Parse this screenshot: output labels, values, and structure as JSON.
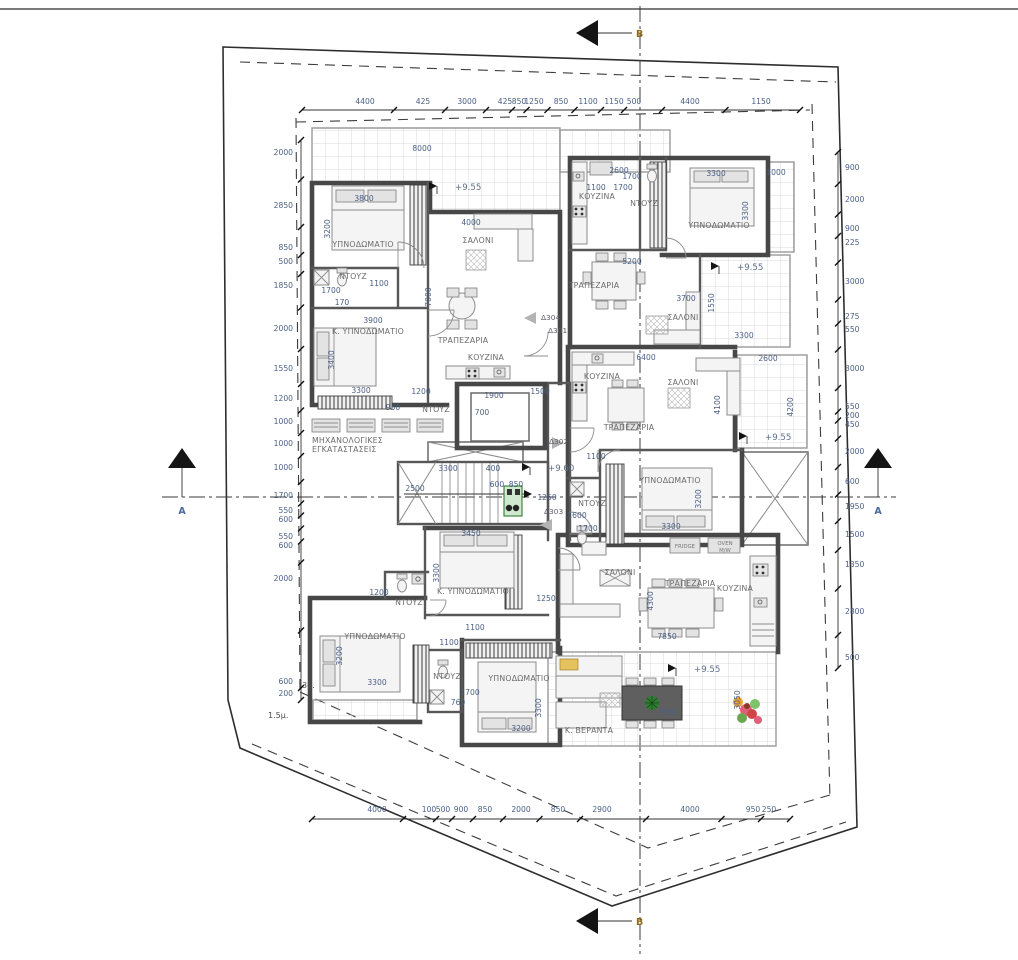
{
  "colors": {
    "dim_text": "#4a5f85",
    "room_text": "#6b6b6b",
    "level_text": "#5f6f8a",
    "section_a": "#4a68a0",
    "section_b": "#8a6a1a",
    "wall": "#474747",
    "plant_green": "#2e7d32",
    "cushion_yellow": "#e6c25e"
  },
  "section_markers": {
    "top": "B",
    "bottom": "B",
    "left": "A",
    "right": "A"
  },
  "levels": [
    {
      "t": "+9.55",
      "x": 455,
      "y": 190
    },
    {
      "t": "+9.55",
      "x": 737,
      "y": 270
    },
    {
      "t": "+9.55",
      "x": 765,
      "y": 440
    },
    {
      "t": "+9.60",
      "x": 548,
      "y": 471
    },
    {
      "t": "+9.55",
      "x": 694,
      "y": 672
    }
  ],
  "door_tags": [
    {
      "t": "Δ304",
      "x": 541,
      "y": 320
    },
    {
      "t": "Δ301",
      "x": 548,
      "y": 333
    },
    {
      "t": "Δ302",
      "x": 549,
      "y": 444
    },
    {
      "t": "Δ303",
      "x": 544,
      "y": 514
    }
  ],
  "setback_labels": [
    {
      "t": "3μ.",
      "x": 302,
      "y": 688
    },
    {
      "t": "1.5μ.",
      "x": 268,
      "y": 718
    }
  ],
  "rooms": [
    {
      "t": "ΥΠΝΟΔΩΜΑΤΙΟ",
      "x": 363,
      "y": 247
    },
    {
      "t": "ΣΑΛΟΝΙ",
      "x": 478,
      "y": 243
    },
    {
      "t": "ΝΤΟΥΖ",
      "x": 353,
      "y": 279
    },
    {
      "t": "Κ. ΥΠΝΟΔΩΜΑΤΙΟ",
      "x": 368,
      "y": 334
    },
    {
      "t": "ΤΡΑΠΕΖΑΡΙΑ",
      "x": 463,
      "y": 343
    },
    {
      "t": "ΚΟΥΖΙΝΑ",
      "x": 486,
      "y": 360
    },
    {
      "t": "ΜΗΧΑΝΟΛΟΓΙΚΕΣ",
      "x": 341,
      "y": 443,
      "a": "start",
      "ax": 312
    },
    {
      "t": "ΕΓΚΑΤΑΣΤΑΣΕΙΣ",
      "x": 338,
      "y": 452,
      "a": "start",
      "ax": 312
    },
    {
      "t": "ΚΟΥΖΙΝΑ",
      "x": 597,
      "y": 199
    },
    {
      "t": "ΝΤΟΥΖ",
      "x": 644,
      "y": 206
    },
    {
      "t": "ΥΠΝΟΔΩΜΑΤΙΟ",
      "x": 719,
      "y": 228
    },
    {
      "t": "ΤΡΑΠΕΖΑΡΙΑ",
      "x": 594,
      "y": 288
    },
    {
      "t": "ΣΑΛΟΝΙ",
      "x": 683,
      "y": 320
    },
    {
      "t": "ΚΟΥΖΙΝΑ",
      "x": 602,
      "y": 379
    },
    {
      "t": "ΣΑΛΟΝΙ",
      "x": 683,
      "y": 385
    },
    {
      "t": "ΤΡΑΠΕΖΑΡΙΑ",
      "x": 629,
      "y": 430
    },
    {
      "t": "ΝΤΟΥΖ",
      "x": 436,
      "y": 412
    },
    {
      "t": "ΥΠΝΟΔΩΜΑΤΙΟ",
      "x": 670,
      "y": 483
    },
    {
      "t": "ΝΤΟΥΖ",
      "x": 592,
      "y": 506
    },
    {
      "t": "Κ. ΥΠΝΟΔΩΜΑΤΙΟ",
      "x": 473,
      "y": 594
    },
    {
      "t": "ΝΤΟΥΖ",
      "x": 409,
      "y": 605
    },
    {
      "t": "ΥΠΝΟΔΩΜΑΤΙΟ",
      "x": 375,
      "y": 639
    },
    {
      "t": "ΝΤΟΥΖ",
      "x": 447,
      "y": 679
    },
    {
      "t": "ΥΠΝΟΔΩΜΑΤΙΟ",
      "x": 519,
      "y": 681
    },
    {
      "t": "ΣΑΛΟΝΙ",
      "x": 620,
      "y": 575
    },
    {
      "t": "ΤΡΑΠΕΖΑΡΙΑ",
      "x": 690,
      "y": 586
    },
    {
      "t": "ΚΟΥΖΙΝΑ",
      "x": 735,
      "y": 591
    },
    {
      "t": "Κ. ΒΕΡΑΝΤΑ",
      "x": 589,
      "y": 733
    }
  ],
  "appliance_labels": [
    {
      "t": "FRIDGE",
      "x": 685,
      "y": 548
    },
    {
      "t": "OVEN",
      "x": 725,
      "y": 545
    },
    {
      "t": "M/W",
      "x": 725,
      "y": 552
    }
  ],
  "plan_dims": [
    {
      "t": "8000",
      "x": 422,
      "y": 151
    },
    {
      "t": "2600",
      "x": 619,
      "y": 173
    },
    {
      "t": "3800",
      "x": 364,
      "y": 201
    },
    {
      "t": "3200",
      "x": 330,
      "y": 229,
      "r": -90
    },
    {
      "t": "4000",
      "x": 471,
      "y": 225
    },
    {
      "t": "1100",
      "x": 379,
      "y": 286
    },
    {
      "t": "1700",
      "x": 331,
      "y": 293
    },
    {
      "t": "170",
      "x": 342,
      "y": 305
    },
    {
      "t": "7000",
      "x": 431,
      "y": 297,
      "r": -90
    },
    {
      "t": "3900",
      "x": 373,
      "y": 323
    },
    {
      "t": "3400",
      "x": 334,
      "y": 360,
      "r": -90
    },
    {
      "t": "3300",
      "x": 361,
      "y": 393
    },
    {
      "t": "950",
      "x": 393,
      "y": 410
    },
    {
      "t": "1200",
      "x": 421,
      "y": 394
    },
    {
      "t": "1900",
      "x": 494,
      "y": 398
    },
    {
      "t": "1500",
      "x": 540,
      "y": 394
    },
    {
      "t": "700",
      "x": 482,
      "y": 415
    },
    {
      "t": "3300",
      "x": 448,
      "y": 471
    },
    {
      "t": "400",
      "x": 493,
      "y": 471
    },
    {
      "t": "600",
      "x": 497,
      "y": 487
    },
    {
      "t": "850",
      "x": 516,
      "y": 487
    },
    {
      "t": "2500",
      "x": 415,
      "y": 491
    },
    {
      "t": "1250",
      "x": 547,
      "y": 500
    },
    {
      "t": "1600",
      "x": 577,
      "y": 518
    },
    {
      "t": "1700",
      "x": 588,
      "y": 531
    },
    {
      "t": "3450",
      "x": 471,
      "y": 536
    },
    {
      "t": "1100",
      "x": 596,
      "y": 190
    },
    {
      "t": "1700",
      "x": 632,
      "y": 179
    },
    {
      "t": "1700",
      "x": 623,
      "y": 190
    },
    {
      "t": "3300",
      "x": 716,
      "y": 176
    },
    {
      "t": "3300",
      "x": 748,
      "y": 211,
      "r": -90
    },
    {
      "t": "1000",
      "x": 776,
      "y": 175
    },
    {
      "t": "5200",
      "x": 632,
      "y": 264
    },
    {
      "t": "3700",
      "x": 686,
      "y": 301
    },
    {
      "t": "1550",
      "x": 714,
      "y": 303,
      "r": -90
    },
    {
      "t": "3300",
      "x": 744,
      "y": 338
    },
    {
      "t": "6400",
      "x": 646,
      "y": 360
    },
    {
      "t": "2600",
      "x": 768,
      "y": 361
    },
    {
      "t": "4100",
      "x": 720,
      "y": 405,
      "r": -90
    },
    {
      "t": "4200",
      "x": 793,
      "y": 407,
      "r": -90
    },
    {
      "t": "1100",
      "x": 596,
      "y": 459
    },
    {
      "t": "3200",
      "x": 701,
      "y": 499,
      "r": -90
    },
    {
      "t": "3300",
      "x": 671,
      "y": 529
    },
    {
      "t": "3300",
      "x": 439,
      "y": 573,
      "r": -90
    },
    {
      "t": "1250",
      "x": 546,
      "y": 601
    },
    {
      "t": "1200",
      "x": 379,
      "y": 595
    },
    {
      "t": "1100",
      "x": 475,
      "y": 630
    },
    {
      "t": "1100",
      "x": 449,
      "y": 645
    },
    {
      "t": "3200",
      "x": 342,
      "y": 656,
      "r": -90
    },
    {
      "t": "3300",
      "x": 377,
      "y": 685
    },
    {
      "t": "1700",
      "x": 470,
      "y": 695
    },
    {
      "t": "760",
      "x": 458,
      "y": 705
    },
    {
      "t": "3300",
      "x": 541,
      "y": 708,
      "r": -90
    },
    {
      "t": "3200",
      "x": 521,
      "y": 731
    },
    {
      "t": "4300",
      "x": 653,
      "y": 601,
      "r": -90
    },
    {
      "t": "7850",
      "x": 667,
      "y": 639
    },
    {
      "t": "3050",
      "x": 740,
      "y": 700,
      "r": -90
    },
    {
      "t": "7850",
      "x": 667,
      "y": 715
    }
  ],
  "dimensions": {
    "top": {
      "axis": "x",
      "label_y": 104,
      "line": {
        "x1": 302,
        "y1": 110,
        "x2": 800,
        "y2": 110
      },
      "labels": [
        {
          "t": "4400",
          "x": 365
        },
        {
          "t": "425",
          "x": 423
        },
        {
          "t": "3000",
          "x": 467
        },
        {
          "t": "425",
          "x": 505
        },
        {
          "t": "850",
          "x": 519
        },
        {
          "t": "1250",
          "x": 534
        },
        {
          "t": "850",
          "x": 561
        },
        {
          "t": "1100",
          "x": 588
        },
        {
          "t": "1150",
          "x": 614
        },
        {
          "t": "500",
          "x": 634
        },
        {
          "t": "4400",
          "x": 690
        },
        {
          "t": "1150",
          "x": 761
        }
      ]
    },
    "bottom": {
      "axis": "x",
      "label_y": 812,
      "line": {
        "x1": 312,
        "y1": 819,
        "x2": 790,
        "y2": 819
      },
      "labels": [
        {
          "t": "4000",
          "x": 377
        },
        {
          "t": "100",
          "x": 429
        },
        {
          "t": "500",
          "x": 443
        },
        {
          "t": "900",
          "x": 461
        },
        {
          "t": "850",
          "x": 485
        },
        {
          "t": "2000",
          "x": 521
        },
        {
          "t": "850",
          "x": 558
        },
        {
          "t": "2900",
          "x": 602
        },
        {
          "t": "4000",
          "x": 690
        },
        {
          "t": "950",
          "x": 753
        },
        {
          "t": "250",
          "x": 769
        }
      ]
    },
    "left": {
      "axis": "y",
      "label_x": 293,
      "line": {
        "x1": 301,
        "y1": 140,
        "x2": 301,
        "y2": 700
      },
      "labels": [
        {
          "t": "2000",
          "y": 153
        },
        {
          "t": "2850",
          "y": 206
        },
        {
          "t": "850",
          "y": 248
        },
        {
          "t": "500",
          "y": 262
        },
        {
          "t": "1850",
          "y": 286
        },
        {
          "t": "2000",
          "y": 329
        },
        {
          "t": "1550",
          "y": 369
        },
        {
          "t": "1200",
          "y": 399
        },
        {
          "t": "1000",
          "y": 422
        },
        {
          "t": "1000",
          "y": 444
        },
        {
          "t": "1000",
          "y": 468
        },
        {
          "t": "1700",
          "y": 496
        },
        {
          "t": "550",
          "y": 511
        },
        {
          "t": "600",
          "y": 520
        },
        {
          "t": "550",
          "y": 537
        },
        {
          "t": "600",
          "y": 546
        },
        {
          "t": "2000",
          "y": 579
        },
        {
          "t": "600",
          "y": 682
        },
        {
          "t": "200",
          "y": 694
        }
      ]
    },
    "right": {
      "axis": "y",
      "label_x": 845,
      "line": {
        "x1": 838,
        "y1": 152,
        "x2": 838,
        "y2": 668
      },
      "labels": [
        {
          "t": "900",
          "y": 168
        },
        {
          "t": "2000",
          "y": 200
        },
        {
          "t": "900",
          "y": 229
        },
        {
          "t": "225",
          "y": 243
        },
        {
          "t": "3000",
          "y": 282
        },
        {
          "t": "275",
          "y": 317
        },
        {
          "t": "550",
          "y": 330
        },
        {
          "t": "3000",
          "y": 369
        },
        {
          "t": "550",
          "y": 407
        },
        {
          "t": "200",
          "y": 416
        },
        {
          "t": "450",
          "y": 425
        },
        {
          "t": "2000",
          "y": 452
        },
        {
          "t": "600",
          "y": 482
        },
        {
          "t": "1950",
          "y": 507
        },
        {
          "t": "1500",
          "y": 535
        },
        {
          "t": "1350",
          "y": 565
        },
        {
          "t": "2800",
          "y": 612
        },
        {
          "t": "500",
          "y": 658
        }
      ]
    }
  }
}
